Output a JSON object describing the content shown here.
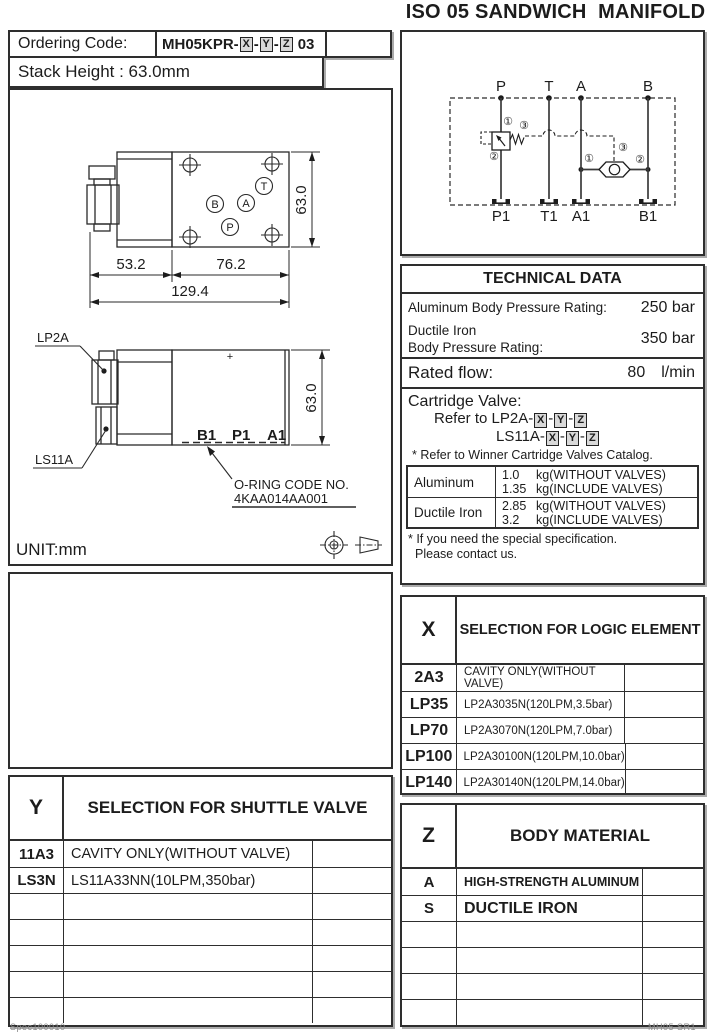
{
  "page": {
    "title": "ISO 05 SANDWICH  MANIFOLD"
  },
  "ordering": {
    "label": "Ordering Code:",
    "code_prefix": "MH05KPR-",
    "x": "X",
    "y": "Y",
    "z": "Z",
    "sep": "-",
    "suffix": "03",
    "stack": "Stack Height : 63.0mm"
  },
  "schematic": {
    "p": "P",
    "t": "T",
    "a": "A",
    "b": "B",
    "p1": "P1",
    "t1": "T1",
    "a1": "A1",
    "b1": "B1",
    "n1": "①",
    "n2": "②",
    "n3": "③"
  },
  "drawing": {
    "dim_53": "53.2",
    "dim_76": "76.2",
    "dim_129": "129.4",
    "dim_63": "63.0",
    "port_b": "B",
    "port_a": "A",
    "port_p": "P",
    "port_t": "T",
    "lp2a": "LP2A",
    "ls11a": "LS11A",
    "plus": "+",
    "b1": "B1",
    "p1": "P1",
    "a1": "A1",
    "front_dim_63": "63.0",
    "oring1": "O-RING CODE NO.",
    "oring2": "4KAA014AA001",
    "unit": "UNIT:mm"
  },
  "technical": {
    "header": "TECHNICAL DATA",
    "alu_label": "Aluminum Body Pressure Rating:",
    "alu_value": "250 bar",
    "di_label1": "Ductile Iron",
    "di_label2": "Body Pressure Rating:",
    "di_value": "350 bar",
    "flow_label": "Rated flow:",
    "flow_value": "80",
    "flow_unit": "l/min",
    "cart_line1": "Cartridge Valve:",
    "cart_line2": "Refer to LP2A-",
    "cart_line3": "LS11A-",
    "x": "X",
    "y": "Y",
    "z": "Z",
    "cart_note": "* Refer to Winner Cartridge Valves Catalog.",
    "weights": [
      {
        "material": "Aluminum",
        "lines": [
          {
            "num": "1.0",
            "text": "kg(WITHOUT VALVES)"
          },
          {
            "num": "1.35",
            "text": "kg(INCLUDE VALVES)"
          }
        ]
      },
      {
        "material": "Ductile Iron",
        "lines": [
          {
            "num": "2.85",
            "text": "kg(WITHOUT VALVES)"
          },
          {
            "num": "3.2",
            "text": "kg(INCLUDE VALVES)"
          }
        ]
      }
    ],
    "note1": "* If you need the special specification.",
    "note2": "Please contact us."
  },
  "x_table": {
    "code": "X",
    "title": "SELECTION FOR LOGIC ELEMENT",
    "rows": [
      {
        "code": "2A3",
        "desc": "CAVITY ONLY(WITHOUT VALVE)"
      },
      {
        "code": "LP35",
        "desc": "LP2A3035N(120LPM,3.5bar)"
      },
      {
        "code": "LP70",
        "desc": "LP2A3070N(120LPM,7.0bar)"
      },
      {
        "code": "LP100",
        "desc": "LP2A30100N(120LPM,10.0bar)"
      },
      {
        "code": "LP140",
        "desc": "LP2A30140N(120LPM,14.0bar)"
      }
    ]
  },
  "y_table": {
    "code": "Y",
    "title": "SELECTION FOR SHUTTLE VALVE",
    "rows": [
      {
        "code": "11A3",
        "desc": "CAVITY ONLY(WITHOUT VALVE)"
      },
      {
        "code": "LS3N",
        "desc": "LS11A33NN(10LPM,350bar)"
      }
    ]
  },
  "z_table": {
    "code": "Z",
    "title": "BODY MATERIAL",
    "rows": [
      {
        "code": "A",
        "desc": "HIGH-STRENGTH ALUMINUM"
      },
      {
        "code": "S",
        "desc": "DUCTILE IRON"
      }
    ]
  },
  "footer": {
    "left": "Spec100010",
    "right": "MH05 SR1"
  },
  "colors": {
    "ink": "#1c1c1c",
    "line": "#2e2e2e",
    "shadow": "#ababab"
  }
}
